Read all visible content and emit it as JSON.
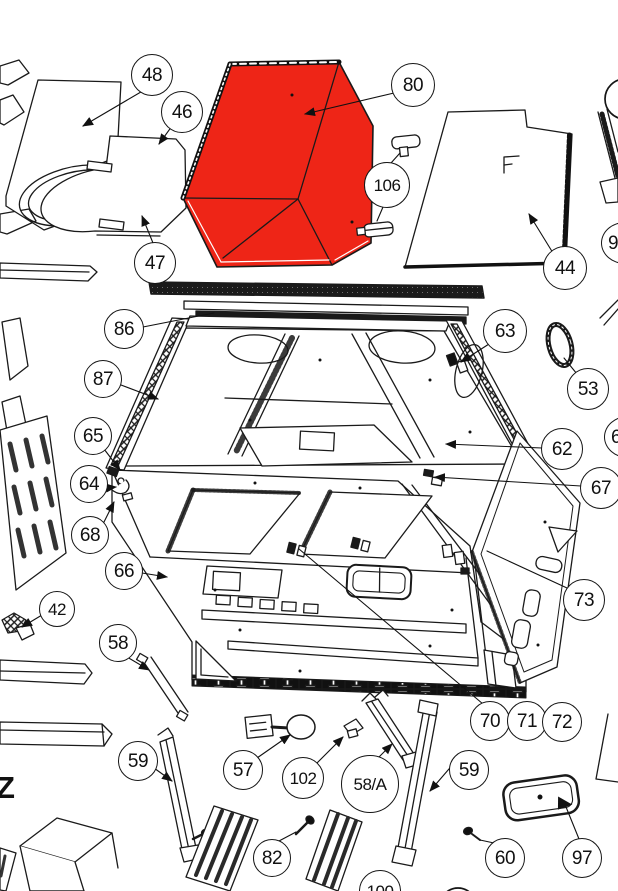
{
  "diagram": {
    "type": "exploded parts diagram",
    "background": "#ffffff",
    "line_color": "#1a1a1a",
    "highlight_color": "#ee2517",
    "highlighted_part_number": "80"
  },
  "annotations": {
    "z_label": "Z"
  },
  "balloons": [
    {
      "label": "48"
    },
    {
      "label": "46"
    },
    {
      "label": "80"
    },
    {
      "label": "47"
    },
    {
      "label": "106"
    },
    {
      "label": "44"
    },
    {
      "label": "86"
    },
    {
      "label": "87"
    },
    {
      "label": "63"
    },
    {
      "label": "53"
    },
    {
      "label": "62"
    },
    {
      "label": "67"
    },
    {
      "label": "65"
    },
    {
      "label": "64"
    },
    {
      "label": "68"
    },
    {
      "label": "66"
    },
    {
      "label": "73"
    },
    {
      "label": "42"
    },
    {
      "label": "58"
    },
    {
      "label": "70"
    },
    {
      "label": "71"
    },
    {
      "label": "72"
    },
    {
      "label": "59"
    },
    {
      "label": "57"
    },
    {
      "label": "102"
    },
    {
      "label": "58/A"
    },
    {
      "label": "59"
    },
    {
      "label": "82"
    },
    {
      "label": "60"
    },
    {
      "label": "97"
    },
    {
      "label": "100"
    },
    {
      "label": "9"
    },
    {
      "label": "6"
    }
  ]
}
